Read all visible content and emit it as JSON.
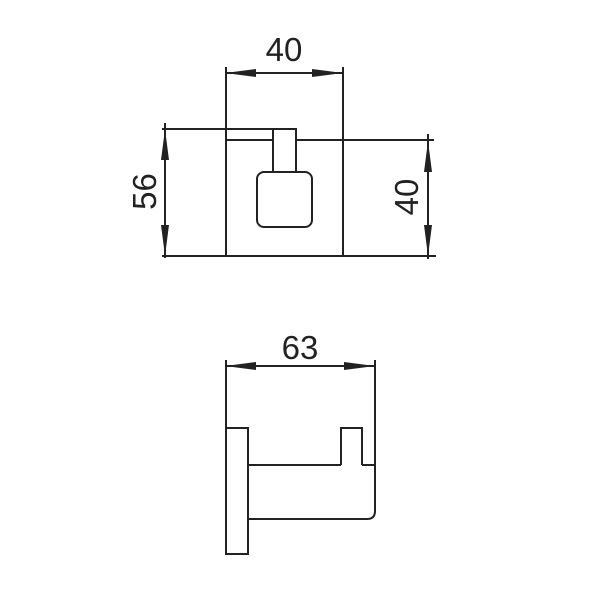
{
  "drawing": {
    "background_color": "#ffffff",
    "line_color": "#222222",
    "front_view": {
      "width_label": "40",
      "height_label": "56",
      "plate_height_label": "40"
    },
    "side_view": {
      "depth_label": "63"
    }
  }
}
